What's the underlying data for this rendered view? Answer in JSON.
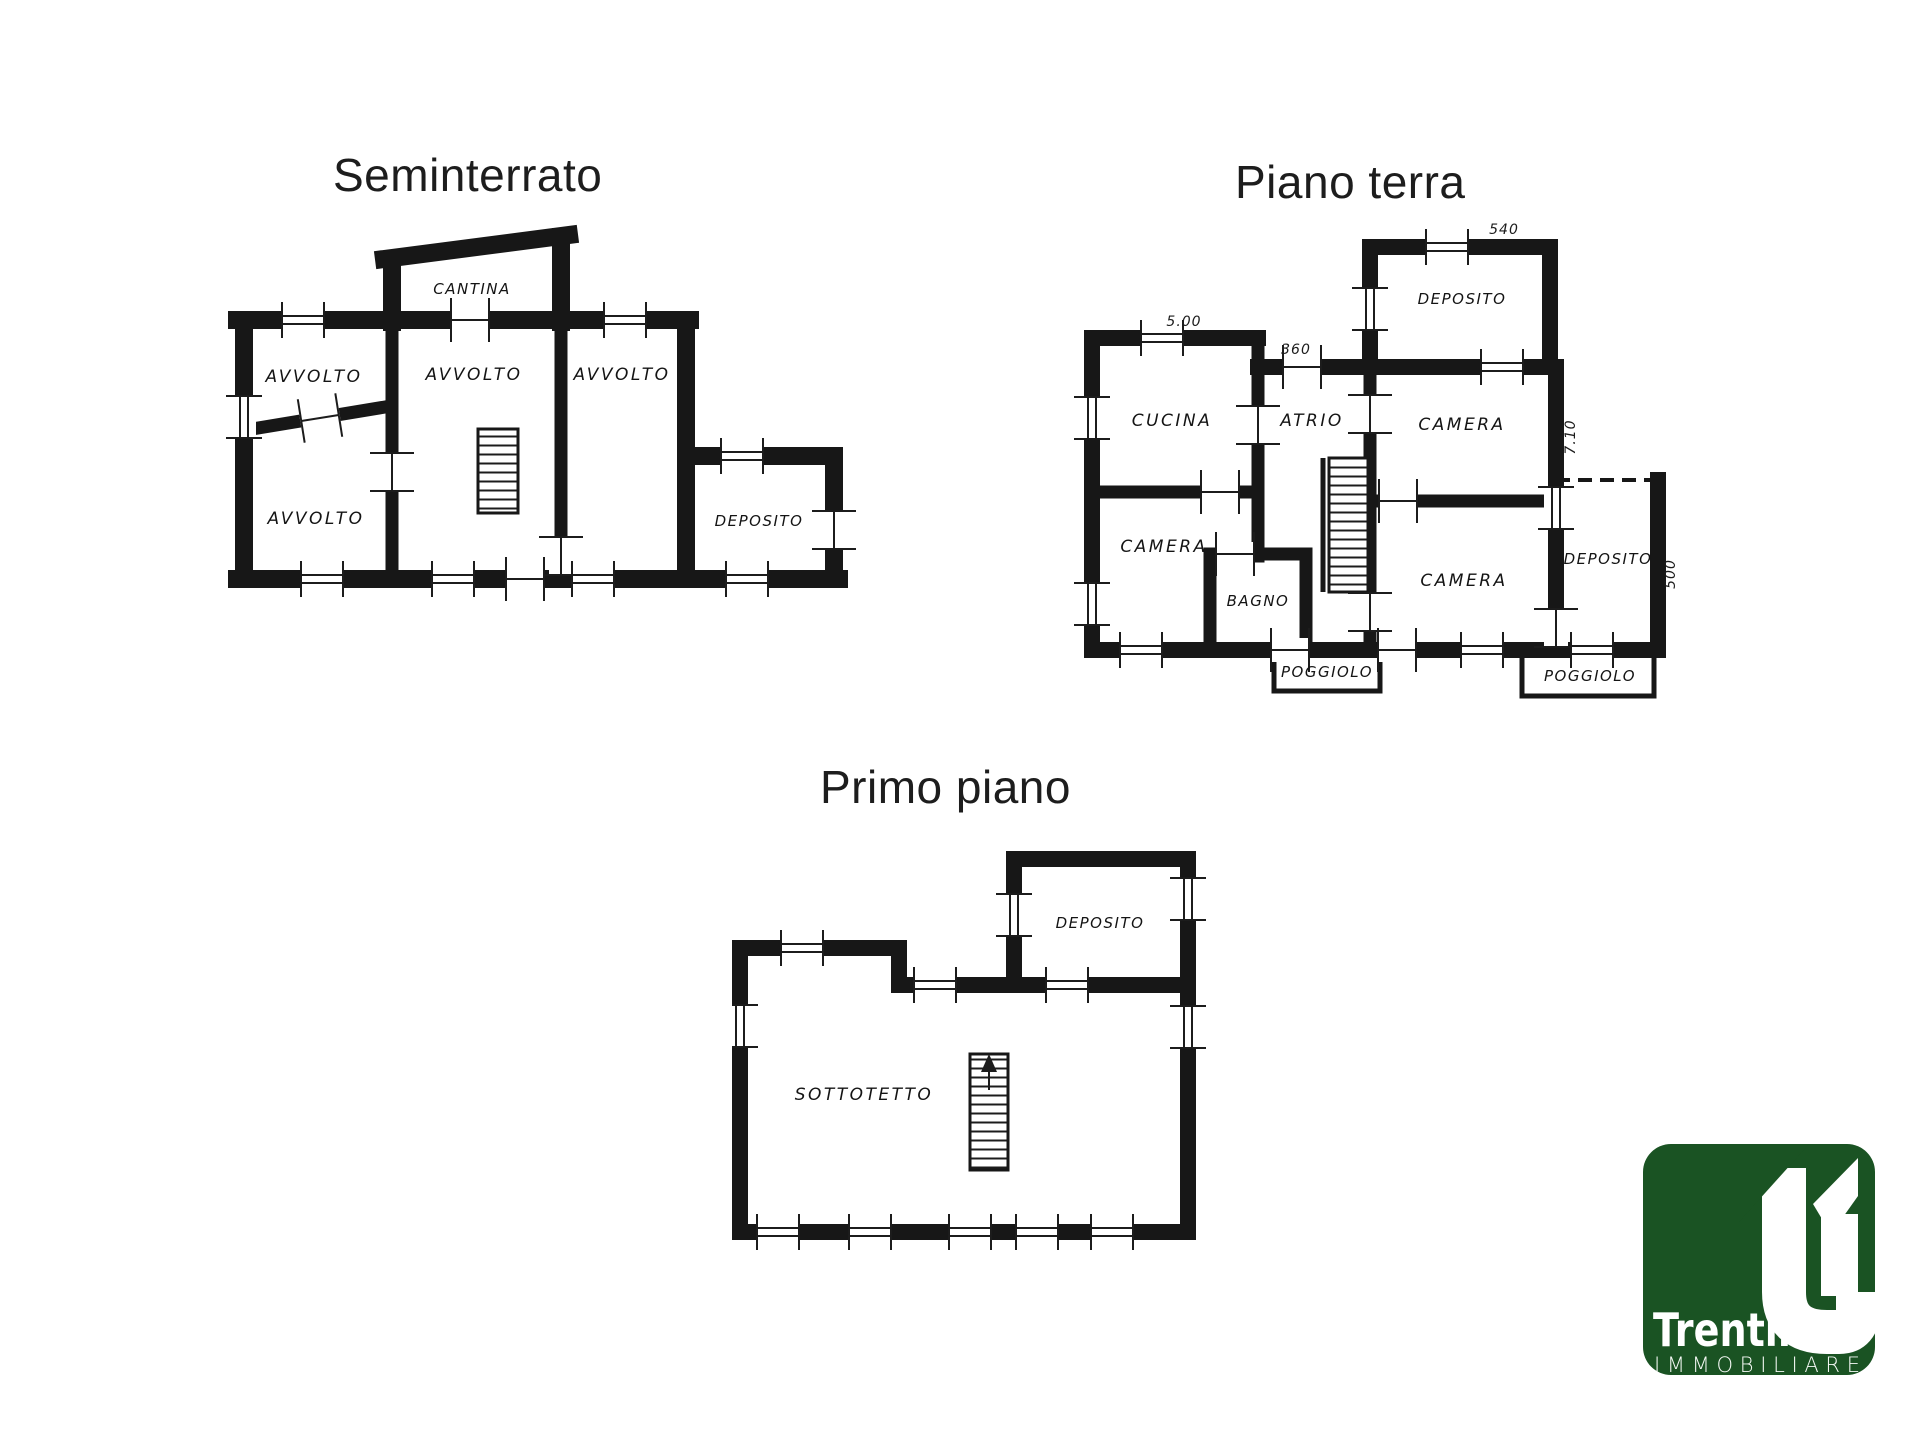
{
  "titles": {
    "seminterrato": "Seminterrato",
    "piano_terra": "Piano terra",
    "primo_piano": "Primo piano"
  },
  "seminterrato": {
    "rooms": {
      "cantina": "CANTINA",
      "avvolto1": "AVVOLTO",
      "avvolto2": "AVVOLTO",
      "avvolto3": "AVVOLTO",
      "avvolto4": "AVVOLTO",
      "deposito": "DEPOSITO"
    }
  },
  "piano_terra": {
    "rooms": {
      "deposito_top": "DEPOSITO",
      "cucina": "CUCINA",
      "atrio": "ATRIO",
      "camera_top": "CAMERA",
      "camera_left": "CAMERA",
      "bagno": "BAGNO",
      "camera_bottom": "CAMERA",
      "deposito_right": "DEPOSITO",
      "poggiolo_center": "POGGIOLO",
      "poggiolo_right": "POGGIOLO"
    },
    "dimensions": {
      "top_cucina": "5.00",
      "atrio": "360",
      "deposito_top": "540",
      "right_side": "7.10",
      "deposito_right": "500"
    }
  },
  "primo_piano": {
    "rooms": {
      "deposito": "DEPOSITO",
      "sottotetto": "SOTTOTETTO"
    }
  },
  "logo": {
    "brand": "Trentin",
    "subtitle": "IMMOBILIARE",
    "green": "#1a5323"
  }
}
